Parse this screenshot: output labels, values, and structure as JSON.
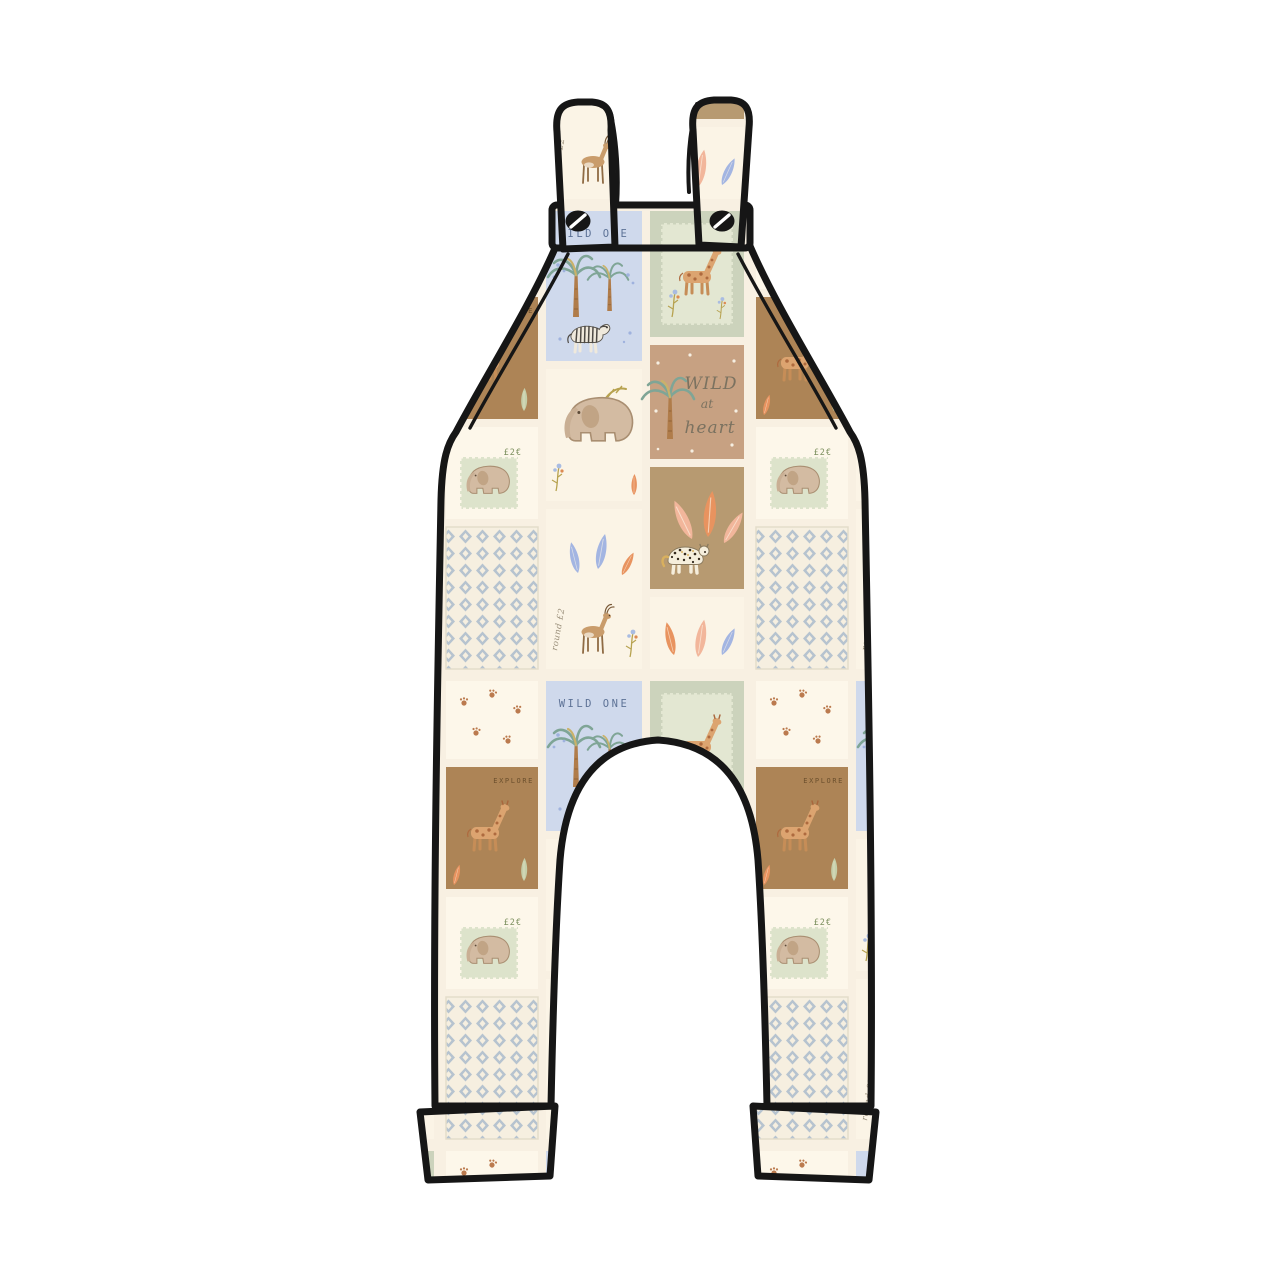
{
  "image": {
    "background_color": "#ffffff",
    "outline_color": "#161616"
  },
  "garment": {
    "kind": "dungarees-illustration",
    "parts": [
      "left-strap",
      "right-strap",
      "chest-band",
      "body-panel",
      "left-leg",
      "right-leg",
      "left-cuff",
      "right-cuff",
      "left-button",
      "right-button"
    ]
  },
  "pattern": {
    "name": "safari-patchwork-print",
    "background": "#f8f0e2",
    "texts": {
      "wild_one": "WILD ONE",
      "explore": "EXPLORE",
      "wild": "WILD",
      "at": "at",
      "heart": "heart",
      "stamp_value": "£2€",
      "script_note": "round £2"
    },
    "colors": {
      "cream": "#fdf7ea",
      "cream_soft": "#fbf4e6",
      "tan": "#c7a182",
      "brown": "#ad8456",
      "leopard_tan": "#b79a71",
      "sage": "#ccd3bc",
      "stamp_sage": "#e3e7d2",
      "pale_blue": "#cfd9ec",
      "diamond_grey": "#b6c3cf",
      "coral": "#e8935f",
      "blush": "#f2b69b",
      "leaf_blue": "#a3b5e2",
      "palm_green": "#7fa596",
      "gold": "#b7a24f",
      "wild_one_text": "#5d7296",
      "explore_text": "#6b4f2c",
      "script_text": "#7b7260",
      "stamp_text": "#7e9160",
      "note_text": "#9a8f7a"
    },
    "motifs": [
      "elephant",
      "giraffe",
      "zebra",
      "leopard",
      "gazelle",
      "palm-tree",
      "leaves",
      "paw-prints",
      "postage-stamp",
      "diamond-check",
      "flower-sprig"
    ]
  }
}
